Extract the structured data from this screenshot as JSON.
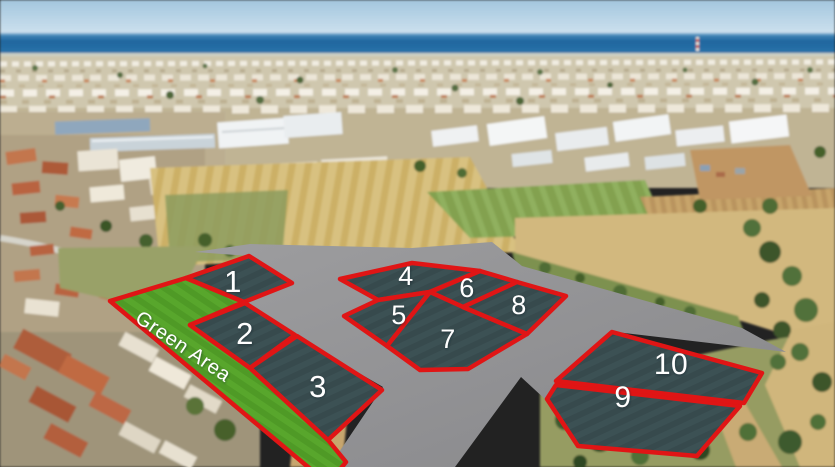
{
  "overlay": {
    "green_area": {
      "label": "Green Area"
    },
    "plots": [
      {
        "label": "1"
      },
      {
        "label": "2"
      },
      {
        "label": "3"
      },
      {
        "label": "4"
      },
      {
        "label": "5"
      },
      {
        "label": "6"
      },
      {
        "label": "7"
      },
      {
        "label": "8"
      },
      {
        "label": "9"
      },
      {
        "label": "10"
      }
    ],
    "colors": {
      "plot_border": "#e01515",
      "plot_fill": "#3c5154",
      "road_gray": "#919194",
      "green_area_fill": "#55a32a",
      "label_text": "#ffffff"
    }
  },
  "scene": {
    "sky_color": "#a7c9e0",
    "sea_color": "#2470a6"
  }
}
